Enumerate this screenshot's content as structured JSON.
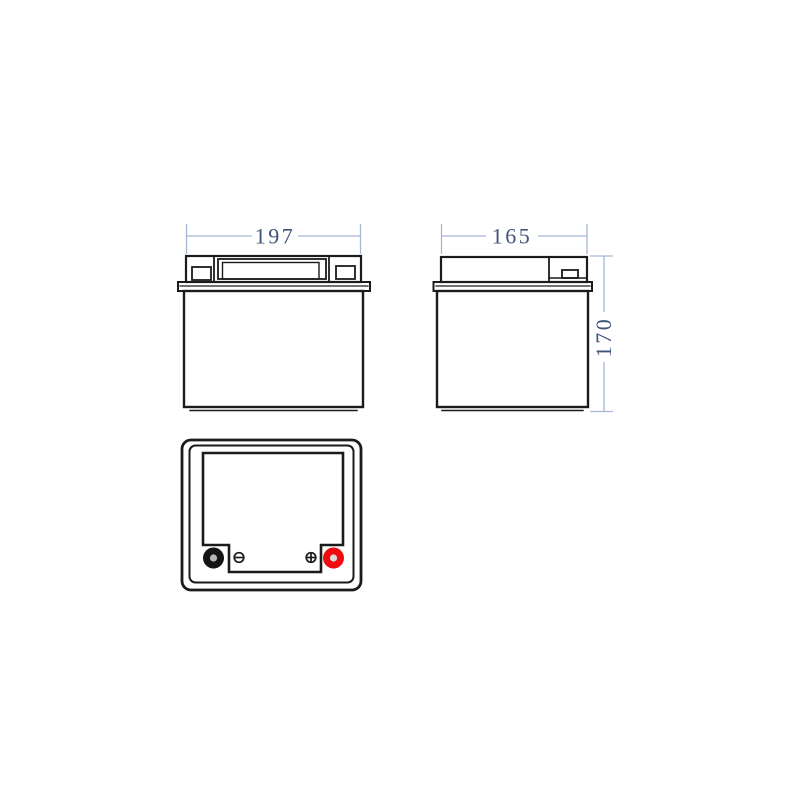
{
  "drawing": {
    "kind": "battery outline technical drawing",
    "views": {
      "front": {
        "name": "front view"
      },
      "side": {
        "name": "side view"
      },
      "top": {
        "name": "top view with terminals"
      }
    },
    "dimensions": {
      "width": "197",
      "depth": "165",
      "height": "170"
    },
    "colors": {
      "outline": "#1b1b1b",
      "dimension_line": "#a6b6d4",
      "dimension_text": "#41537a",
      "negative_terminal": "#141414",
      "positive_terminal": "#ef0a10",
      "negative_terminal_core": "#b5b5b5",
      "positive_terminal_core": "#dcdcdc",
      "background": "#ffffff"
    }
  }
}
